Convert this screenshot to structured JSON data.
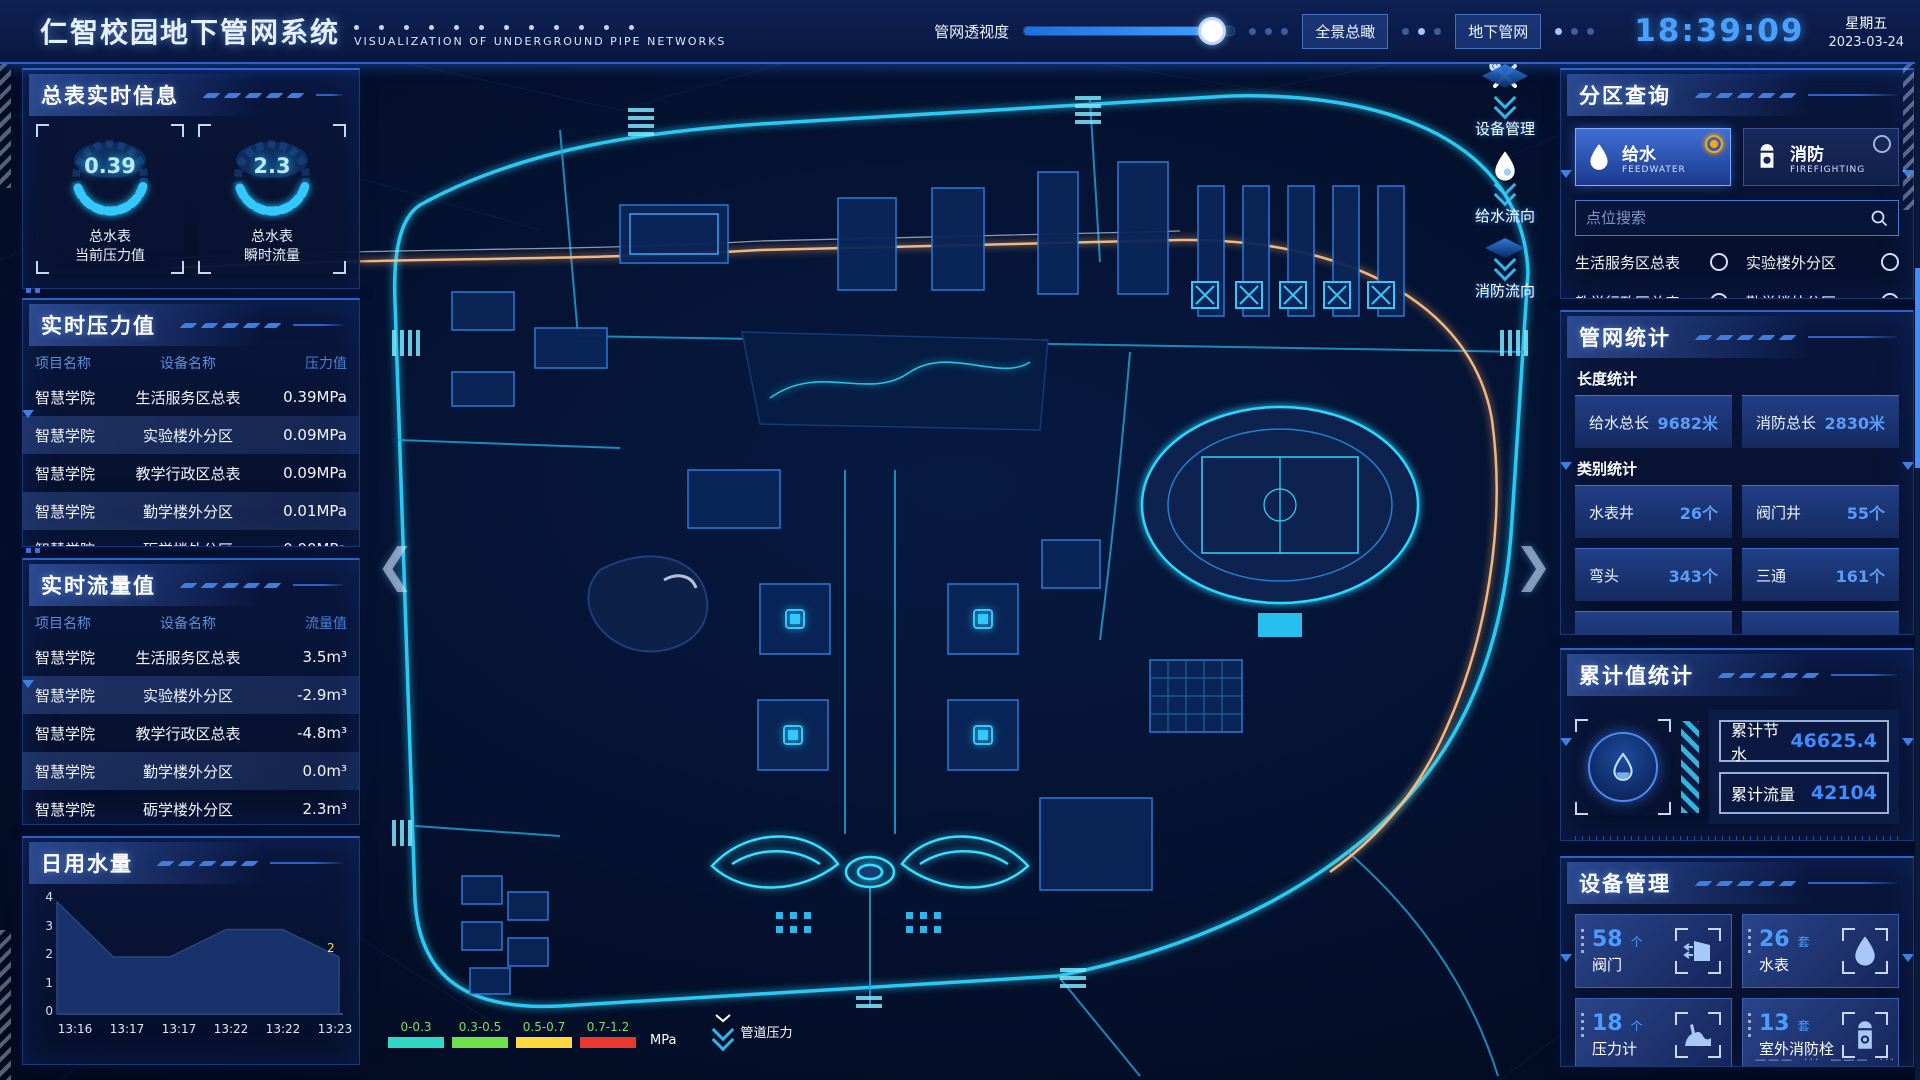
{
  "header": {
    "title": "仁智校园地下管网系统",
    "subtitle": "VISUALIZATION OF UNDERGROUND PIPE NETWORKS",
    "opacity_label": "管网透视度",
    "btn_overview": "全景总瞰",
    "btn_underground": "地下管网",
    "clock": "18:39:09",
    "weekday": "星期五",
    "date": "2023-03-24"
  },
  "left": {
    "realtime_info": {
      "title": "总表实时信息",
      "gauges": [
        {
          "value": "0.39",
          "label1": "总水表",
          "label2": "当前压力值"
        },
        {
          "value": "2.3",
          "label1": "总水表",
          "label2": "瞬时流量"
        }
      ]
    },
    "pressure": {
      "title": "实时压力值",
      "headers": [
        "项目名称",
        "设备名称",
        "压力值"
      ],
      "rows": [
        {
          "project": "智慧学院",
          "device": "生活服务区总表",
          "value": "0.39MPa"
        },
        {
          "project": "智慧学院",
          "device": "实验楼外分区",
          "value": "0.09MPa"
        },
        {
          "project": "智慧学院",
          "device": "教学行政区总表",
          "value": "0.09MPa"
        },
        {
          "project": "智慧学院",
          "device": "勤学楼外分区",
          "value": "0.01MPa"
        },
        {
          "project": "智慧学院",
          "device": "砺学楼外分区",
          "value": "0.00MPa"
        }
      ]
    },
    "flow": {
      "title": "实时流量值",
      "headers": [
        "项目名称",
        "设备名称",
        "流量值"
      ],
      "rows": [
        {
          "project": "智慧学院",
          "device": "生活服务区总表",
          "value": "3.5m³"
        },
        {
          "project": "智慧学院",
          "device": "实验楼外分区",
          "value": "-2.9m³"
        },
        {
          "project": "智慧学院",
          "device": "教学行政区总表",
          "value": "-4.8m³"
        },
        {
          "project": "智慧学院",
          "device": "勤学楼外分区",
          "value": "0.0m³"
        },
        {
          "project": "智慧学院",
          "device": "砺学楼外分区",
          "value": "2.3m³"
        }
      ]
    },
    "daily_water": {
      "title": "日用水量"
    }
  },
  "chart_data": {
    "type": "area",
    "title": "日用水量",
    "x": [
      "13:16",
      "13:17",
      "13:17",
      "13:22",
      "13:22",
      "13:23"
    ],
    "values": [
      4,
      2,
      2,
      3,
      3,
      2
    ],
    "ylim": [
      0,
      4
    ],
    "yticks": [
      0,
      1,
      2,
      3,
      4
    ],
    "end_label": "2",
    "area_color": "#1b3470",
    "xlabel": "",
    "ylabel": "",
    "legend_position": "none",
    "grid": false
  },
  "map": {
    "controls": [
      {
        "label": "设备管理",
        "icon": "tools-icon"
      },
      {
        "label": "给水流向",
        "icon": "water-drop-icon"
      },
      {
        "label": "消防流向",
        "icon": "fire-flow-icon"
      }
    ],
    "legend": {
      "ranges": [
        "0-0.3",
        "0.3-0.5",
        "0.5-0.7",
        "0.7-1.2"
      ],
      "colors": [
        "#2fd8c3",
        "#6ee14b",
        "#ffd83d",
        "#e8392c"
      ],
      "unit": "MPa",
      "pipe_label": "管道压力"
    }
  },
  "right": {
    "zone_query": {
      "title": "分区查询",
      "tabs": [
        {
          "label": "给水",
          "sub": "FEEDWATER"
        },
        {
          "label": "消防",
          "sub": "FIREFIGHTING"
        }
      ],
      "search_placeholder": "点位搜索",
      "items": [
        "生活服务区总表",
        "实验楼外分区",
        "教学行政区总表",
        "勤学楼外分区",
        "砺学楼外分区",
        "宿舍区泵房"
      ]
    },
    "pipe_stats": {
      "title": "管网统计",
      "length_label": "长度统计",
      "length_stats": [
        {
          "label": "给水总长",
          "value": "9682米"
        },
        {
          "label": "消防总长",
          "value": "2830米"
        }
      ],
      "category_label": "类别统计",
      "category_stats": [
        {
          "label": "水表井",
          "value": "26个"
        },
        {
          "label": "阀门井",
          "value": "55个"
        },
        {
          "label": "弯头",
          "value": "343个"
        },
        {
          "label": "三通",
          "value": "161个"
        }
      ]
    },
    "cumulative": {
      "title": "累计值统计",
      "rows": [
        {
          "label": "累计节水",
          "value": "46625.4"
        },
        {
          "label": "累计流量",
          "value": "42104"
        }
      ]
    },
    "devices": {
      "title": "设备管理",
      "cards": [
        {
          "count": "58",
          "unit": "个",
          "name": "阀门",
          "icon": "valve-icon"
        },
        {
          "count": "26",
          "unit": "套",
          "name": "水表",
          "icon": "water-meter-icon"
        },
        {
          "count": "18",
          "unit": "个",
          "name": "压力计",
          "icon": "pressure-gauge-icon"
        },
        {
          "count": "13",
          "unit": "套",
          "name": "室外消防栓",
          "icon": "hydrant-icon"
        }
      ]
    }
  }
}
